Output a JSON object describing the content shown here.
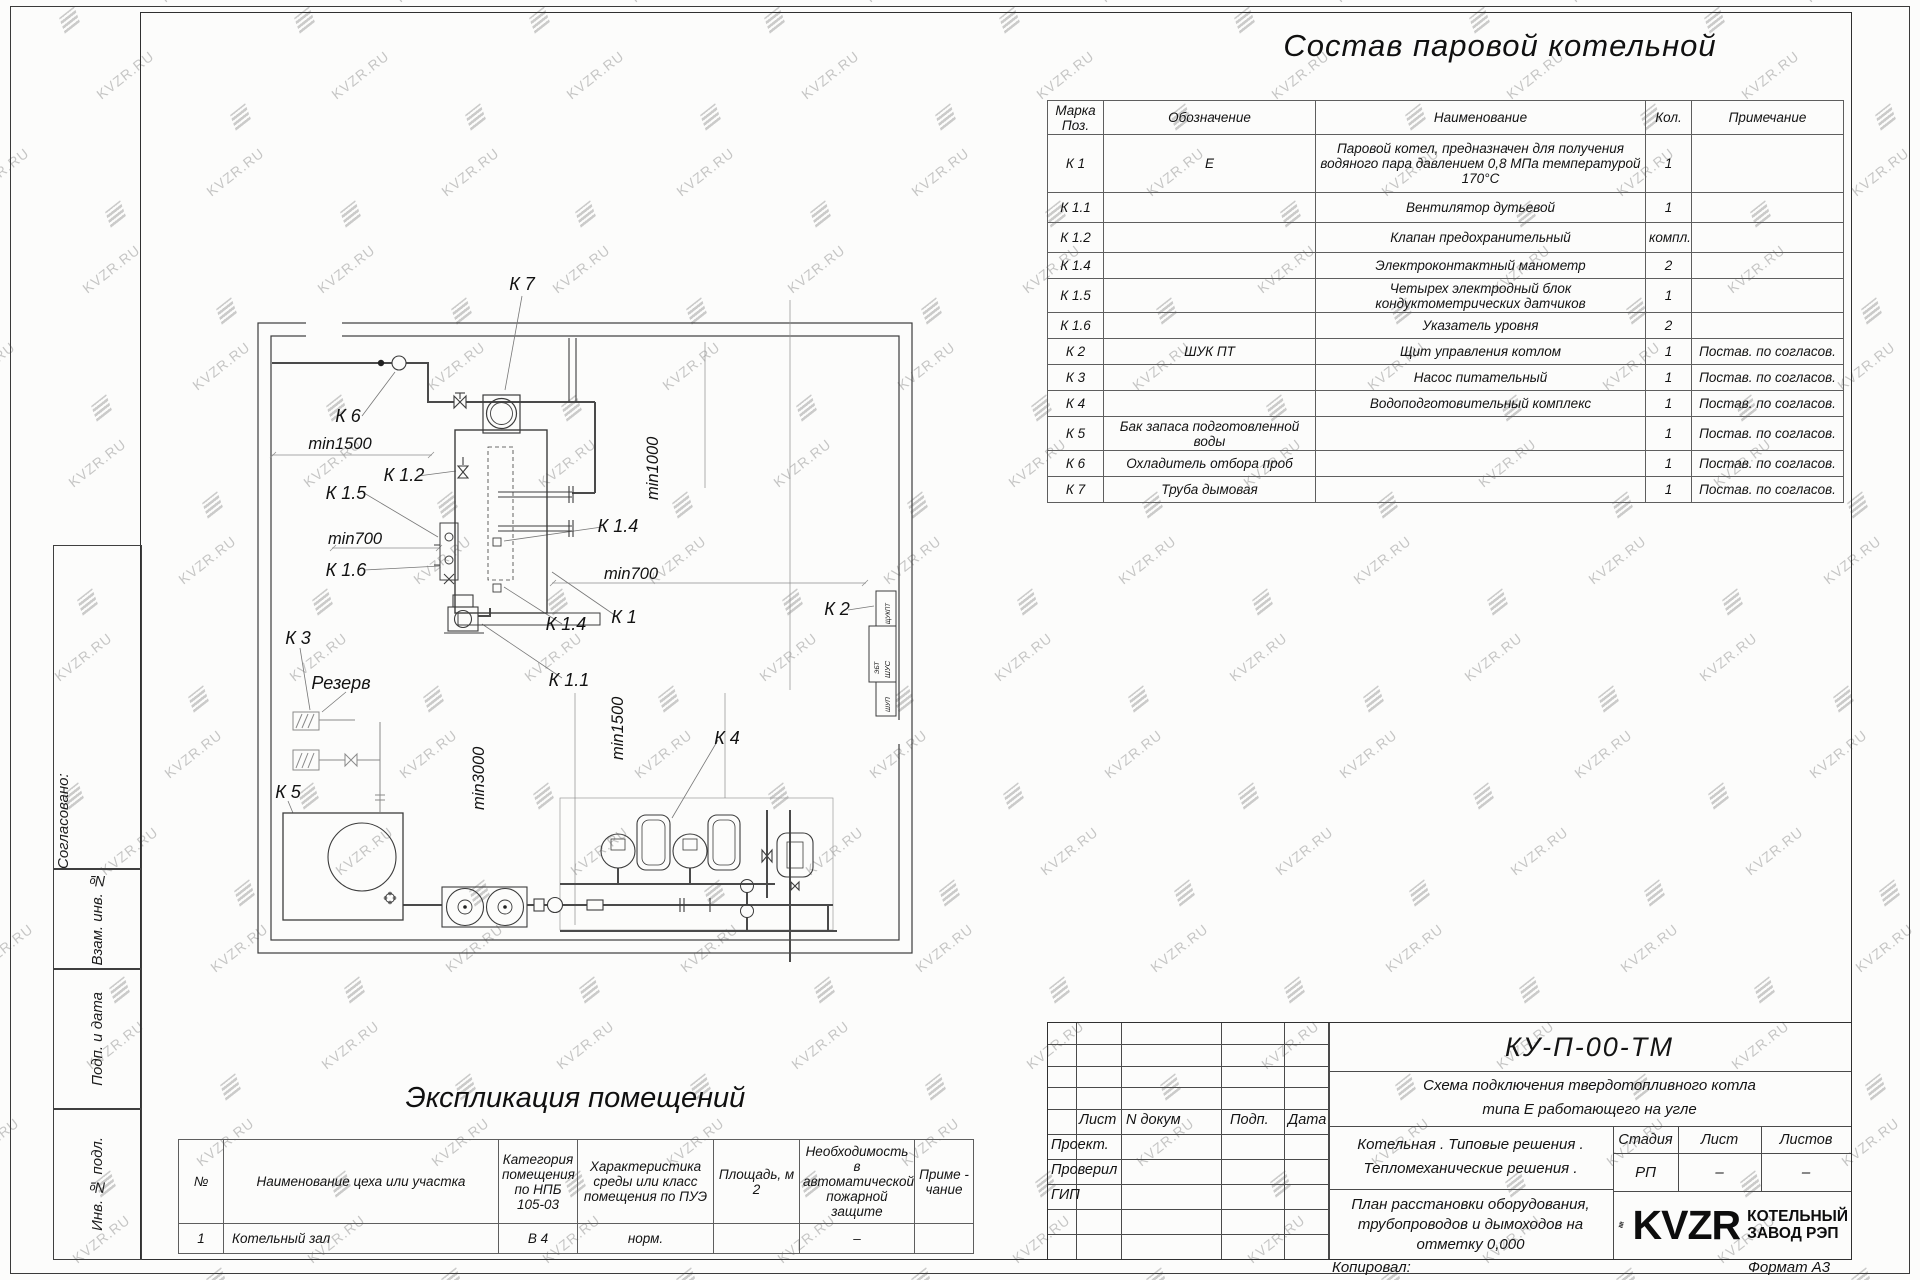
{
  "watermark": {
    "text": "KVZR.RU",
    "color": "#8f8f8f"
  },
  "colors": {
    "line": "#3c3c3c",
    "brand_black": "#0d0d0d"
  },
  "sheet": {
    "title": "Состав паровой котельной",
    "copied_label": "Копировал:",
    "format_label": "Формат А3"
  },
  "margin": {
    "approved": "Согласовано:",
    "vzam": "Взам. инв. №",
    "podp": "Подп. и дата",
    "inv": "Инв. № подл."
  },
  "components_table": {
    "headers": {
      "mark": "Марка Поз.",
      "designation": "Обозначение",
      "name": "Наименование",
      "qty": "Кол.",
      "note": "Примечание"
    },
    "rows": [
      {
        "mark": "К 1",
        "designation": "Е",
        "name": "Паровой котел, предназначен для получения водяного пара давлением 0,8 МПа температурой 170°С",
        "qty": "1",
        "note": ""
      },
      {
        "mark": "К 1.1",
        "designation": "",
        "name": "Вентилятор дутьевой",
        "qty": "1",
        "note": ""
      },
      {
        "mark": "К 1.2",
        "designation": "",
        "name": "Клапан предохранительный",
        "qty": "компл.",
        "note": ""
      },
      {
        "mark": "К 1.4",
        "designation": "",
        "name": "Электроконтактный манометр",
        "qty": "2",
        "note": ""
      },
      {
        "mark": "К 1.5",
        "designation": "",
        "name": "Четырех электродный блок кондуктометрических датчиков",
        "qty": "1",
        "note": ""
      },
      {
        "mark": "К 1.6",
        "designation": "",
        "name": "Указатель уровня",
        "qty": "2",
        "note": ""
      },
      {
        "mark": "К 2",
        "designation": "ШУК ПТ",
        "name": "Щит управления котлом",
        "qty": "1",
        "note": "Постав. по согласов."
      },
      {
        "mark": "К 3",
        "designation": "",
        "name": "Насос питательный",
        "qty": "1",
        "note": "Постав. по согласов."
      },
      {
        "mark": "К 4",
        "designation": "",
        "name": "Водоподготовительный комплекс",
        "qty": "1",
        "note": "Постав. по согласов."
      },
      {
        "mark": "К 5",
        "designation": "Бак запаса подготовленной воды",
        "name": "",
        "qty": "1",
        "note": "Постав. по согласов."
      },
      {
        "mark": "К 6",
        "designation": "Охладитель отбора проб",
        "name": "",
        "qty": "1",
        "note": "Постав. по согласов."
      },
      {
        "mark": "К 7",
        "designation": "Труба дымовая",
        "name": "",
        "qty": "1",
        "note": "Постав. по согласов."
      }
    ]
  },
  "explication": {
    "title": "Экспликация помещений",
    "headers": [
      "№",
      "Наименование цеха или участка",
      "Категория помещения по НПБ 105-03",
      "Характеристика среды или класс помещения по ПУЭ",
      "Площадь, м 2",
      "Необходимость в автоматической пожарной защите",
      "Приме - чание"
    ],
    "row": [
      "1",
      "Котельный зал",
      "В 4",
      "норм.",
      "",
      "–",
      ""
    ]
  },
  "title_block": {
    "doc_code": "КУ-П-00-ТМ",
    "doc_title_line1": "Схема подключения твердотопливного котла",
    "doc_title_line2": "типа Е работающего на угле",
    "header_cells": [
      "Лист",
      "N докум",
      "Подп.",
      "Дата"
    ],
    "roles": [
      "Проект.",
      "Проверил",
      "ГИП"
    ],
    "object_line1": "Котельная . Типовые решения .",
    "object_line2": "Тепломеханические решения .",
    "sheet_name": "План расстановки оборудования, трубопроводов и дымоходов на отметку 0,000",
    "stage_headers": [
      "Стадия",
      "Лист",
      "Листов"
    ],
    "stage_values": [
      "РП",
      "–",
      "–"
    ],
    "logo_text": "KVZR",
    "logo_line1": "КОТЕЛЬНЫЙ",
    "logo_line2": "ЗАВОД РЭП"
  },
  "plan": {
    "labels": {
      "k7": "К 7",
      "k6": "К 6",
      "min1500_top": "min1500",
      "k12": "К 1.2",
      "k15": "К 1.5",
      "min700_left": "min700",
      "k16": "К 1.6",
      "k3": "К 3",
      "rezerv": "Резерв",
      "k5": "К 5",
      "min3000": "min3000",
      "k11": "К 1.1",
      "min1500_mid": "min1500",
      "k4": "К 4",
      "min1000": "min1000",
      "k14_right": "К 1.4",
      "min700_right": "min700",
      "k2": "К 2",
      "k1": "К 1",
      "k14_bottom": "К 1.4",
      "panel_box1": "ЩУКПТ",
      "panel_box2a": "ЭБТ",
      "panel_box2b": "ШУС",
      "panel_box3": "ШУП"
    }
  }
}
